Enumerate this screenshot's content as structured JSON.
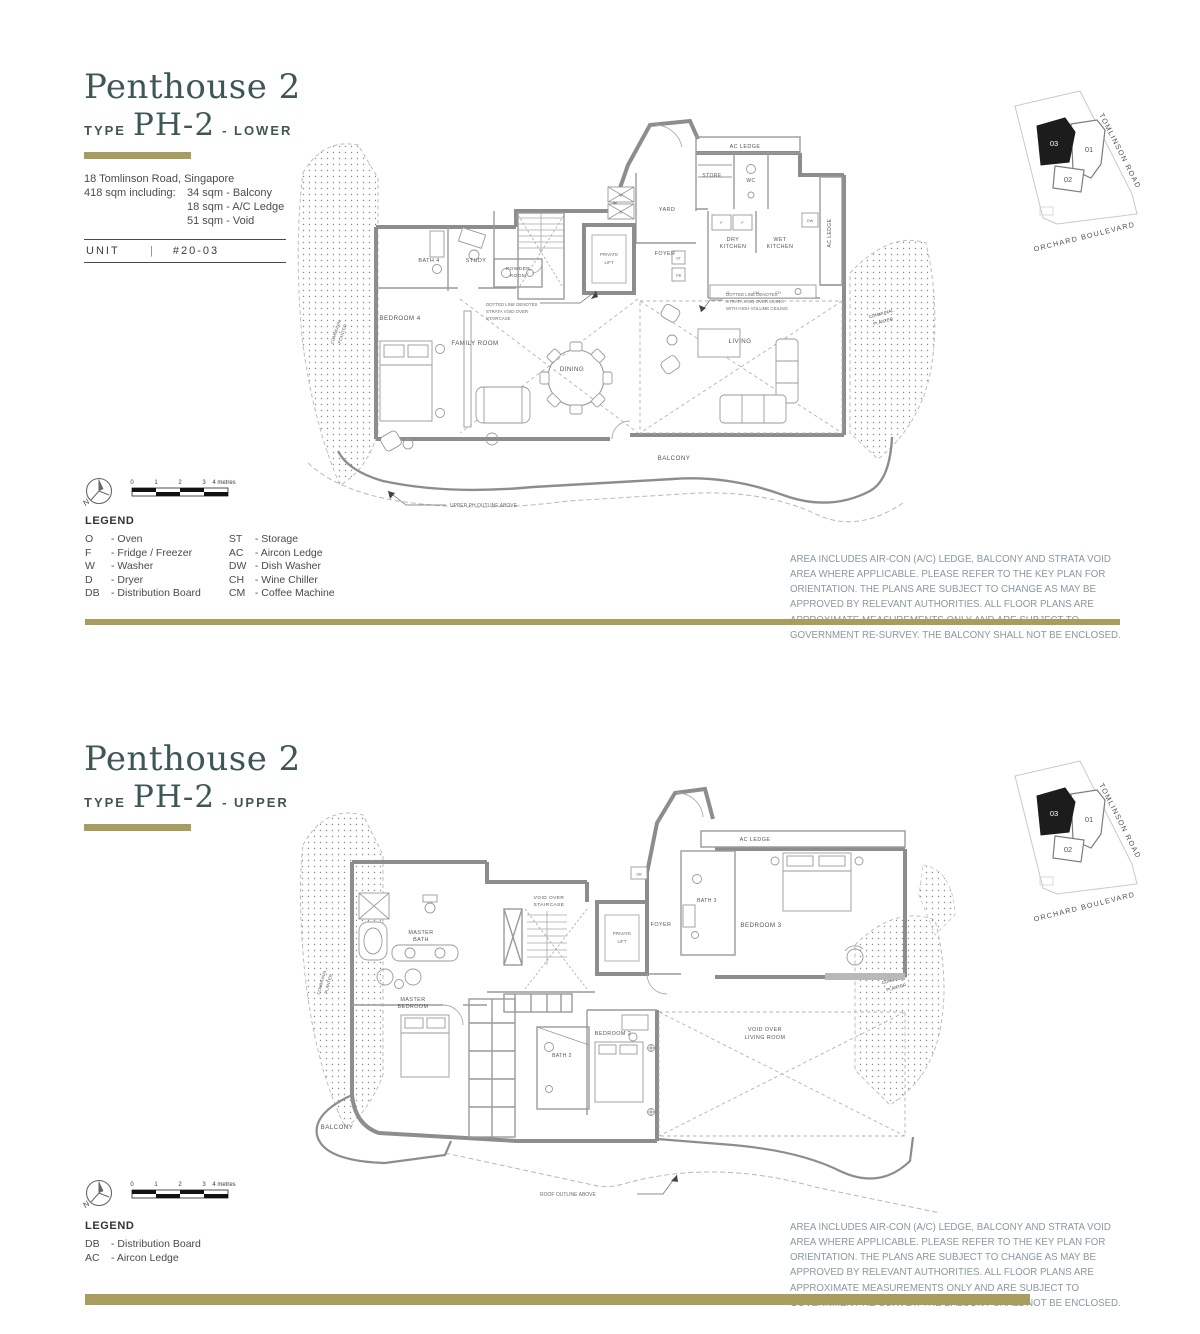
{
  "colors": {
    "gold": "#a89c5f",
    "title": "#3e5756",
    "disclaimer_text": "#8a97a2",
    "plan_line": "#8d8d8d"
  },
  "shared": {
    "disclaimer": "AREA INCLUDES AIR-CON (A/C) LEDGE, BALCONY AND STRATA VOID AREA WHERE APPLICABLE. PLEASE REFER TO THE KEY PLAN FOR ORIENTATION. THE PLANS ARE SUBJECT TO CHANGE AS MAY BE APPROVED BY RELEVANT AUTHORITIES. ALL FLOOR PLANS ARE APPROXIMATE MEASUREMENTS ONLY AND ARE SUBJECT TO GOVERNMENT RE-SURVEY. THE BALCONY SHALL NOT BE ENCLOSED.",
    "scale_ticks": [
      "0",
      "1",
      "2",
      "3"
    ],
    "scale_end": "4 metres",
    "north": "N",
    "keyplan": {
      "u01": "01",
      "u02": "02",
      "u03": "03",
      "road_top": "TOMLINSON ROAD",
      "road_bottom": "ORCHARD BOULEVARD"
    }
  },
  "lower": {
    "title": "Penthouse 2",
    "type_label": "TYPE",
    "type_code": "PH-2",
    "variant": "- LOWER",
    "address": "18 Tomlinson Road, Singapore",
    "area_label": "418 sqm including:",
    "area_items": [
      "34 sqm - Balcony",
      "18 sqm - A/C Ledge",
      "51 sqm - Void"
    ],
    "unit_label": "UNIT",
    "unit_sep": "|",
    "unit_value": "#20-03",
    "legend": {
      "title": "LEGEND",
      "col1": [
        {
          "abbr": "O",
          "desc": "- Oven"
        },
        {
          "abbr": "F",
          "desc": "- Fridge / Freezer"
        },
        {
          "abbr": "W",
          "desc": "- Washer"
        },
        {
          "abbr": "D",
          "desc": "- Dryer"
        },
        {
          "abbr": "DB",
          "desc": "- Distribution Board"
        }
      ],
      "col2": [
        {
          "abbr": "ST",
          "desc": "- Storage"
        },
        {
          "abbr": "AC",
          "desc": "- Aircon Ledge"
        },
        {
          "abbr": "DW",
          "desc": "- Dish Washer"
        },
        {
          "abbr": "CH",
          "desc": "- Wine Chiller"
        },
        {
          "abbr": "CM",
          "desc": "- Coffee Machine"
        }
      ]
    },
    "rooms": {
      "ac_ledge_top": "AC LEDGE",
      "ac_ledge_right": "AC LEDGE",
      "store": "STORE",
      "wc": "WC",
      "yard": "YARD",
      "dry_kitchen": [
        "DRY",
        "KITCHEN"
      ],
      "wet_kitchen": [
        "WET",
        "KITCHEN"
      ],
      "private_lift": [
        "PRIVATE",
        "LIFT"
      ],
      "foyer": "FOYER",
      "powder": [
        "POWDER",
        "ROOM"
      ],
      "study": "STUDY",
      "bath4": "BATH 4",
      "bedroom4": "BEDROOM 4",
      "family": "FAMILY ROOM",
      "dining": "DINING",
      "living": "LIVING",
      "balcony": "BALCONY",
      "planter": [
        "COMMUNAL",
        "PLANTER"
      ]
    },
    "fixtures": {
      "w": "W",
      "d": "D",
      "f": "F",
      "dw": "DW",
      "o": "O",
      "cm": "CM",
      "ch": "CH",
      "st": "ST",
      "db": "DB"
    },
    "notes": {
      "staircase": [
        "DOTTED LINE DENOTES",
        "STRATA VOID OVER",
        "STAIRCASE"
      ],
      "living": [
        "DOTTED LINE DENOTES",
        "STRATA VOID OVER LIVING",
        "WITH HIGH VOLUME CEILING"
      ],
      "outline": "UPPER PH OUTLINE ABOVE"
    }
  },
  "upper": {
    "title": "Penthouse 2",
    "type_label": "TYPE",
    "type_code": "PH-2",
    "variant": "- UPPER",
    "legend": {
      "title": "LEGEND",
      "col1": [
        {
          "abbr": "DB",
          "desc": "- Distribution Board"
        },
        {
          "abbr": "AC",
          "desc": "- Aircon Ledge"
        }
      ]
    },
    "rooms": {
      "ac_ledge": "AC LEDGE",
      "bath3": "BATH 3",
      "bedroom3": "BEDROOM 3",
      "void_staircase": [
        "VOID OVER",
        "STAIRCASE"
      ],
      "private_lift": [
        "PRIVATE",
        "LIFT"
      ],
      "foyer": "FOYER",
      "master_bath": [
        "MASTER",
        "BATH"
      ],
      "master_bedroom": [
        "MASTER",
        "BEDROOM"
      ],
      "bath2": "BATH 2",
      "bedroom2": "BEDROOM 2",
      "void_living": [
        "VOID OVER",
        "LIVING ROOM"
      ],
      "balcony": "BALCONY",
      "planter": [
        "COMMUNAL",
        "PLANTER"
      ]
    },
    "fixtures": {
      "db": "DB"
    },
    "notes": {
      "roof": "ROOF OUTLINE ABOVE"
    }
  }
}
